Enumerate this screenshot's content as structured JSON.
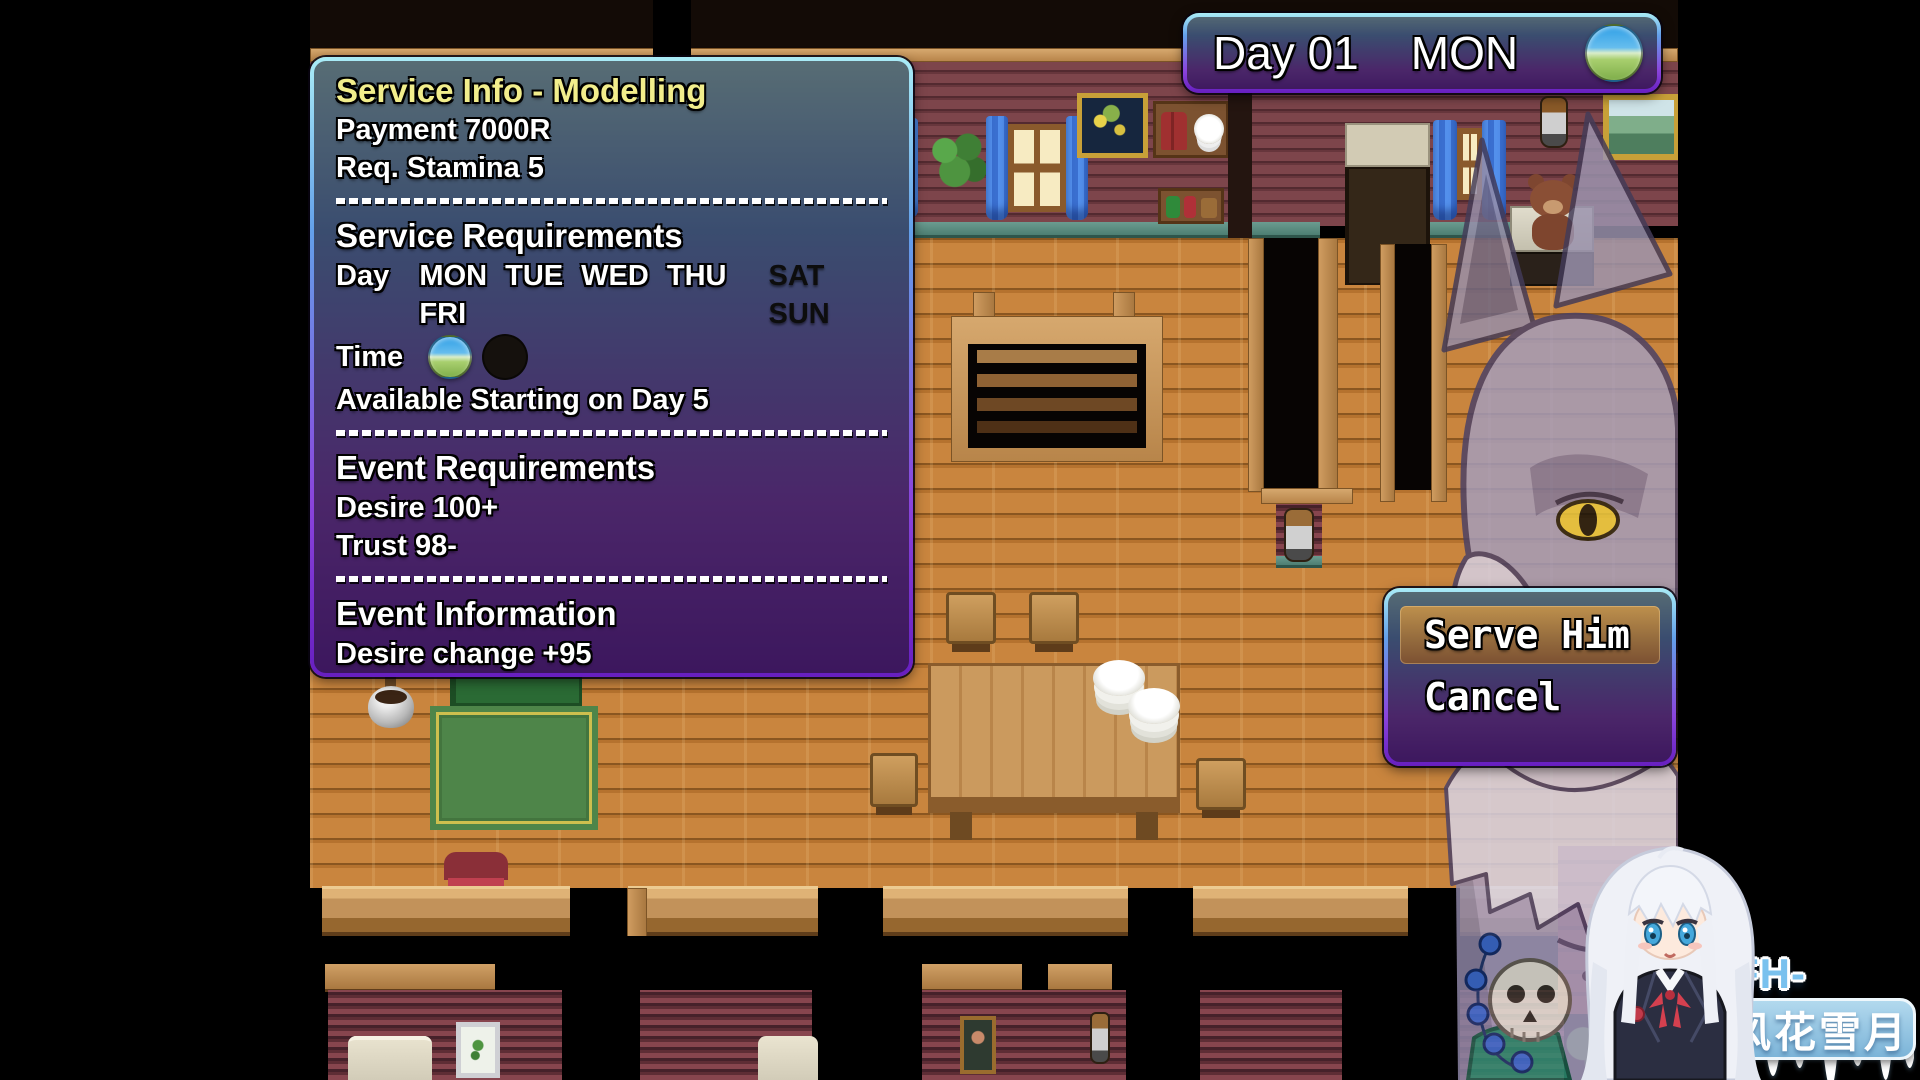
{
  "hud": {
    "day_text": "Day 01",
    "weekday": "MON",
    "time_icon": "day-cycle-icon"
  },
  "service_info": {
    "title": "Service Info - Modelling",
    "payment": "Payment 7000R",
    "stamina": "Req. Stamina 5",
    "requirements": {
      "heading": "Service Requirements",
      "day_label": "Day",
      "days_available": "MON TUE WED THU FRI",
      "days_unavailable": "SAT SUN",
      "time_label": "Time",
      "availability_note": "Available Starting on Day 5"
    },
    "event_requirements": {
      "heading": "Event Requirements",
      "desire": "Desire 100+",
      "trust": "Trust 98-"
    },
    "event_information": {
      "heading": "Event Information",
      "desire_change": "Desire change +95",
      "trust_change": "Trust change"
    }
  },
  "choice_menu": {
    "serve": "Serve Him",
    "cancel": "Cancel"
  },
  "watermark": {
    "site": "FH-XY.NET",
    "brand": "风花雪月"
  },
  "colors": {
    "title_yellow": "#f2ee8c",
    "text_white": "#ffffff",
    "disabled_day_text": "#0d0d0d",
    "selection_orange": "#d98a2b",
    "window_border_top": "#a9ecf6",
    "window_border_bottom": "#671fc0",
    "brick_floor": "#b5722e",
    "watermark_blue": "#79c1ee"
  }
}
